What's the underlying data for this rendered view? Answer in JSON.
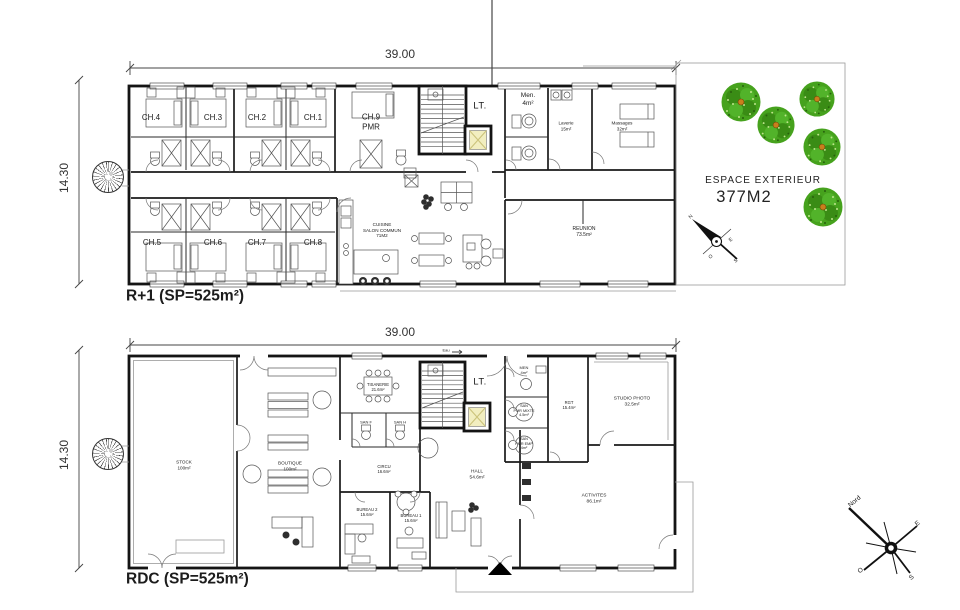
{
  "floor_r1": {
    "title": "R+1 (SP=525m²)",
    "dim_width": "39.00",
    "dim_height": "14.30",
    "rooms": {
      "ch1": "CH.1",
      "ch2": "CH.2",
      "ch3": "CH.3",
      "ch4": "CH.4",
      "ch5": "CH.5",
      "ch6": "CH.6",
      "ch7": "CH.7",
      "ch8": "CH.8",
      "ch9": "CH.9\nPMR",
      "lt": "LT.",
      "men": "Men.\n4m²",
      "laverie": "Laverie\n15m²",
      "massages": "Massages\n32m²",
      "cuisine": "CUISINE\nSALON COMMUN\n71M2",
      "reunion": "REUNION\n73.5m²"
    },
    "compass": {
      "n": "N",
      "e": "E",
      "o": "O",
      "s": "S"
    }
  },
  "exterior": {
    "label": "ESPACE EXTERIEUR",
    "area": "377M2",
    "tree_color": "#46a21d"
  },
  "floor_rdc": {
    "title": "RDC (SP=525m²)",
    "dim_width": "39.00",
    "dim_height": "14.30",
    "rooms": {
      "stock": "STOCK\n100m²",
      "boutique": "BOUTIQUE\n100m²",
      "tisanerie": "TISANERIE\n21.6m²",
      "lt": "LT.",
      "men": "MEN\n4m²",
      "san_f": "SAN F",
      "san_h": "SAN H",
      "circu": "CIRCU\n16.6m²",
      "san_pmr_mixte": "SAN\nPMR MIXTE\n4.5m²",
      "san_pmr_emp": "SAN\nPMR EMP\n4m²",
      "rgt": "RGT\n15.4m²",
      "studio_photo": "STUDIO PHOTO\n32.5m²",
      "hall": "HALL\n54.6m²",
      "bureau1": "BUREAU 1\n15.6m²",
      "bureau2": "BUREAU 2\n15.6m²",
      "activites": "ACTIVITES\n86.1m²",
      "eau": "Eau"
    },
    "compass": {
      "nord": "Nord",
      "e": "E",
      "o": "O",
      "s": "S"
    }
  }
}
